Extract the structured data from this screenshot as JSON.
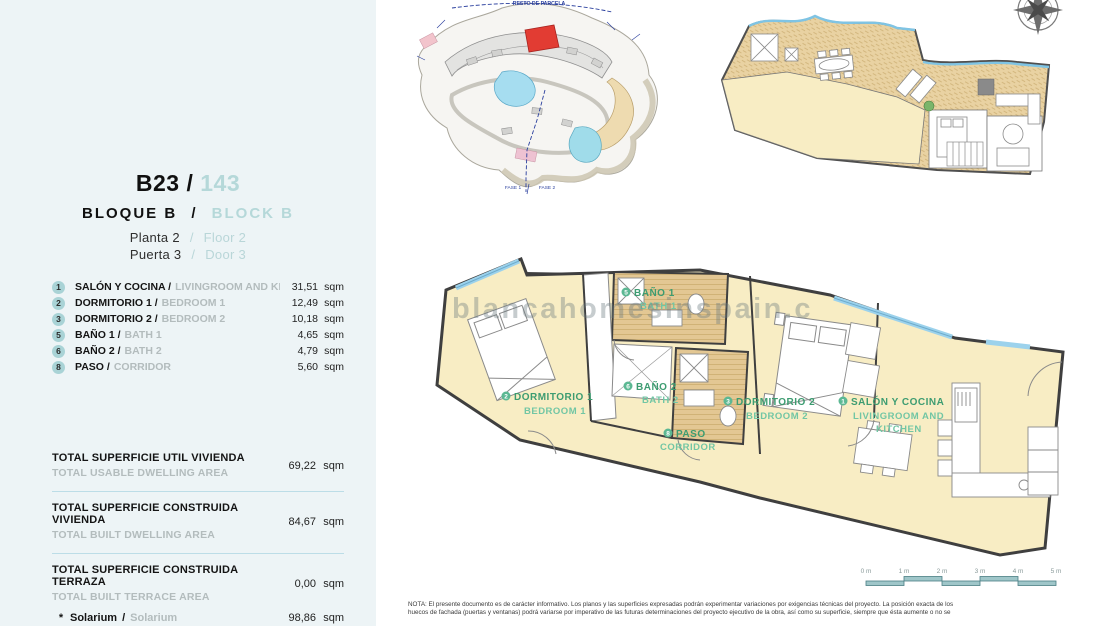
{
  "sep": "/",
  "units": {
    "sqm": "sqm"
  },
  "colors": {
    "panel_bg": "#edf4f6",
    "accent_teal": "#b5d8d9",
    "badge_teal": "#a9d3d6",
    "separator_blue": "#bcdde7",
    "plan_room_yellow": "#f8edc4",
    "plan_bath_tan": "#e3c793",
    "solarium_tan": "#e9d2a2",
    "glazing_blue": "#9cd2ec",
    "label_green": "#3d9c71",
    "label_green_light": "#72c6a4",
    "site_red": "#e23c33",
    "site_blue": "#2a3f9e"
  },
  "panel": {
    "unit_code": "B23 /",
    "unit_number": "143",
    "block_es": "BLOQUE B",
    "block_en": "BLOCK B",
    "floor_es": "Planta 2",
    "floor_en": "Floor 2",
    "door_es": "Puerta 3",
    "door_en": "Door 3",
    "rooms": [
      {
        "num": "1",
        "es": "SALÓN Y COCINA /",
        "en": "LIVINGROOM AND KITCHEN",
        "area": "31,51"
      },
      {
        "num": "2",
        "es": "DORMITORIO 1 /",
        "en": "BEDROOM 1",
        "area": "12,49"
      },
      {
        "num": "3",
        "es": "DORMITORIO 2 /",
        "en": "BEDROOM 2",
        "area": "10,18"
      },
      {
        "num": "5",
        "es": "BAÑO 1 /",
        "en": "BATH 1",
        "area": "4,65"
      },
      {
        "num": "6",
        "es": "BAÑO 2 /",
        "en": "BATH 2",
        "area": "4,79"
      },
      {
        "num": "8",
        "es": "PASO /",
        "en": "CORRIDOR",
        "area": "5,60"
      }
    ],
    "totals": [
      {
        "es": "TOTAL SUPERFICIE UTIL VIVIENDA",
        "en": "TOTAL USABLE DWELLING AREA",
        "value": "69,22"
      },
      {
        "es": "TOTAL SUPERFICIE CONSTRUIDA VIVIENDA",
        "en": "TOTAL BUILT DWELLING AREA",
        "value": "84,67"
      },
      {
        "es": "TOTAL SUPERFICIE CONSTRUIDA TERRAZA",
        "en": "TOTAL BUILT TERRACE AREA",
        "value": "0,00"
      }
    ],
    "solarium": {
      "prefix": "*",
      "es": "Solarium",
      "en": "Solarium",
      "value": "98,86"
    }
  },
  "site_plan": {
    "resto_label": "RESTO DE PARCELA",
    "fase1": "FASE 1",
    "fase2": "FASE 2"
  },
  "main_plan": {
    "watermark": "blancahomesinspain.c",
    "labels": {
      "salon": {
        "num": "1",
        "es": "SALÓN Y COCINA",
        "en1": "LIVINGROOM AND",
        "en2": "KITCHEN"
      },
      "dorm1": {
        "num": "2",
        "es": "DORMITORIO 1",
        "en": "BEDROOM 1"
      },
      "dorm2": {
        "num": "3",
        "es": "DORMITORIO 2",
        "en": "BEDROOM 2"
      },
      "bath1": {
        "num": "5",
        "es": "BAÑO 1",
        "en": "BATH 1"
      },
      "bath2": {
        "num": "6",
        "es": "BAÑO 2",
        "en": "BATH 2"
      },
      "paso": {
        "num": "8",
        "es": "PASO",
        "en": "CORRIDOR"
      }
    }
  },
  "scale_bar": {
    "labels": [
      "0 m",
      "1 m",
      "2 m",
      "3 m",
      "4 m",
      "5 m"
    ]
  },
  "note": {
    "line1": "NOTA: El presente documento es de carácter informativo. Los planos y las superficies expresadas podrán experimentar variaciones por exigencias técnicas del proyecto. La posición exacta de los",
    "line2": "huecos de fachada (puertas y ventanas) podrá variarse por imperativo de las futuras determinaciones del proyecto ejecutivo de la obra, así como su superficie, siempre que ésta aumente o no se"
  }
}
